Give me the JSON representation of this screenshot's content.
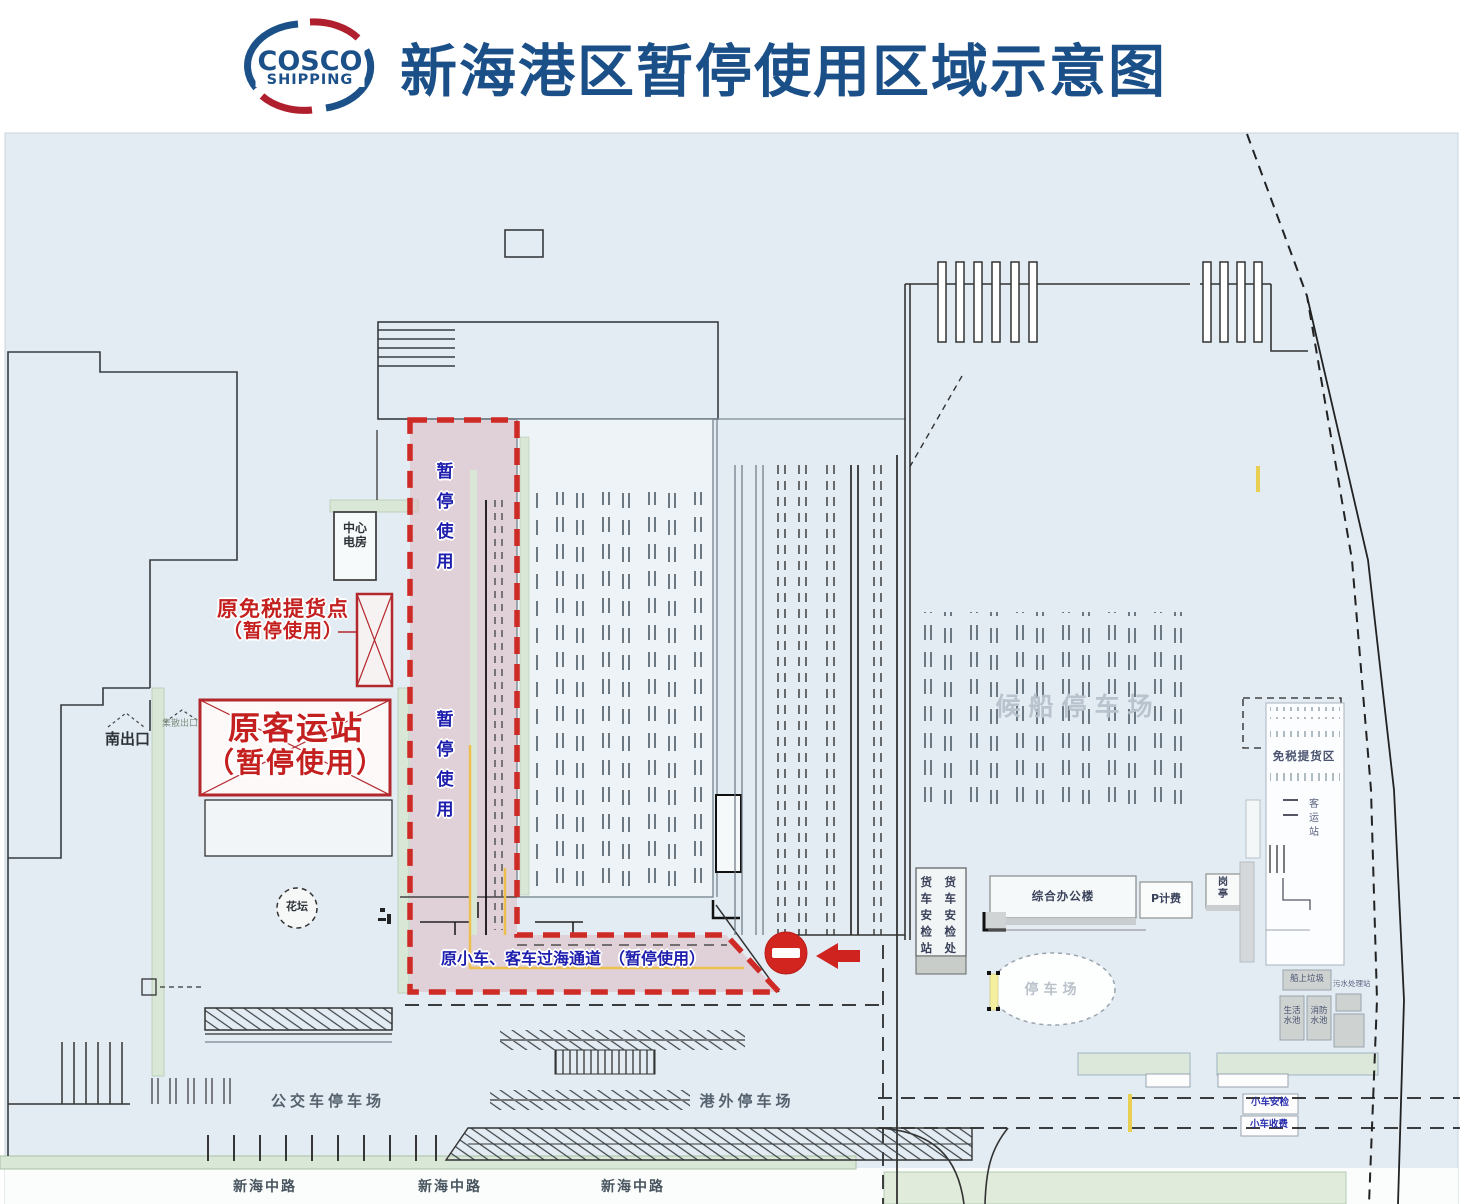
{
  "header": {
    "logo": {
      "line1": "COSCO",
      "line2": "SHIPPING"
    },
    "title": "新海港区暂停使用区域示意图"
  },
  "suspended_zone": {
    "vertical_label_top": "暂停使用",
    "vertical_label_bottom": "暂停使用",
    "channel_label": "原小车、客车过海通道　（暂停使用）"
  },
  "closed_facilities": {
    "duty_free_pickup": {
      "line1": "原免税提货点",
      "line2": "（暂停使用）"
    },
    "passenger_station": {
      "line1": "原客运站",
      "line2": "（暂停使用）"
    }
  },
  "areas": {
    "waiting_ship_parking": "候船停车场",
    "bus_parking": "公交车停车场",
    "outside_port_parking": "港外停车场",
    "oval_parking": "停车场",
    "duty_free_pickup_area": "免税提货区"
  },
  "facilities": {
    "south_exit": "南出口",
    "gathering_exit": "集散出口",
    "central_power_room": "中心电房",
    "flower_bed": "花坛",
    "truck_security_station": "货车安检站",
    "truck_security_office": "货车安检处",
    "office_building": "综合办公楼",
    "p_toll": "P计费",
    "guard_booth": "岗亭",
    "passenger_station_new": "客运站",
    "ship_garbage": "船上垃圾",
    "sewage_station": "污水处理站",
    "domestic_water_pool": "生活水池",
    "fire_water_pool": "消防水池",
    "car_security_check": "小车安检",
    "car_toll": "小车收费"
  },
  "roads": {
    "road_1": "新海中路",
    "road_2": "新海中路",
    "road_3": "新海中路"
  },
  "colors": {
    "title_blue": "#1b4f88",
    "annotation_blue": "#1d1dae",
    "closed_red": "#c3201f",
    "zone_border_red": "#ce2a26",
    "zone_fill_pink": "#e7cdd3",
    "map_background": "#e3ecf3",
    "green_strip": "#d9e7d7",
    "no_entry_red": "#d3251f",
    "yellow_line": "#e8cf52"
  }
}
